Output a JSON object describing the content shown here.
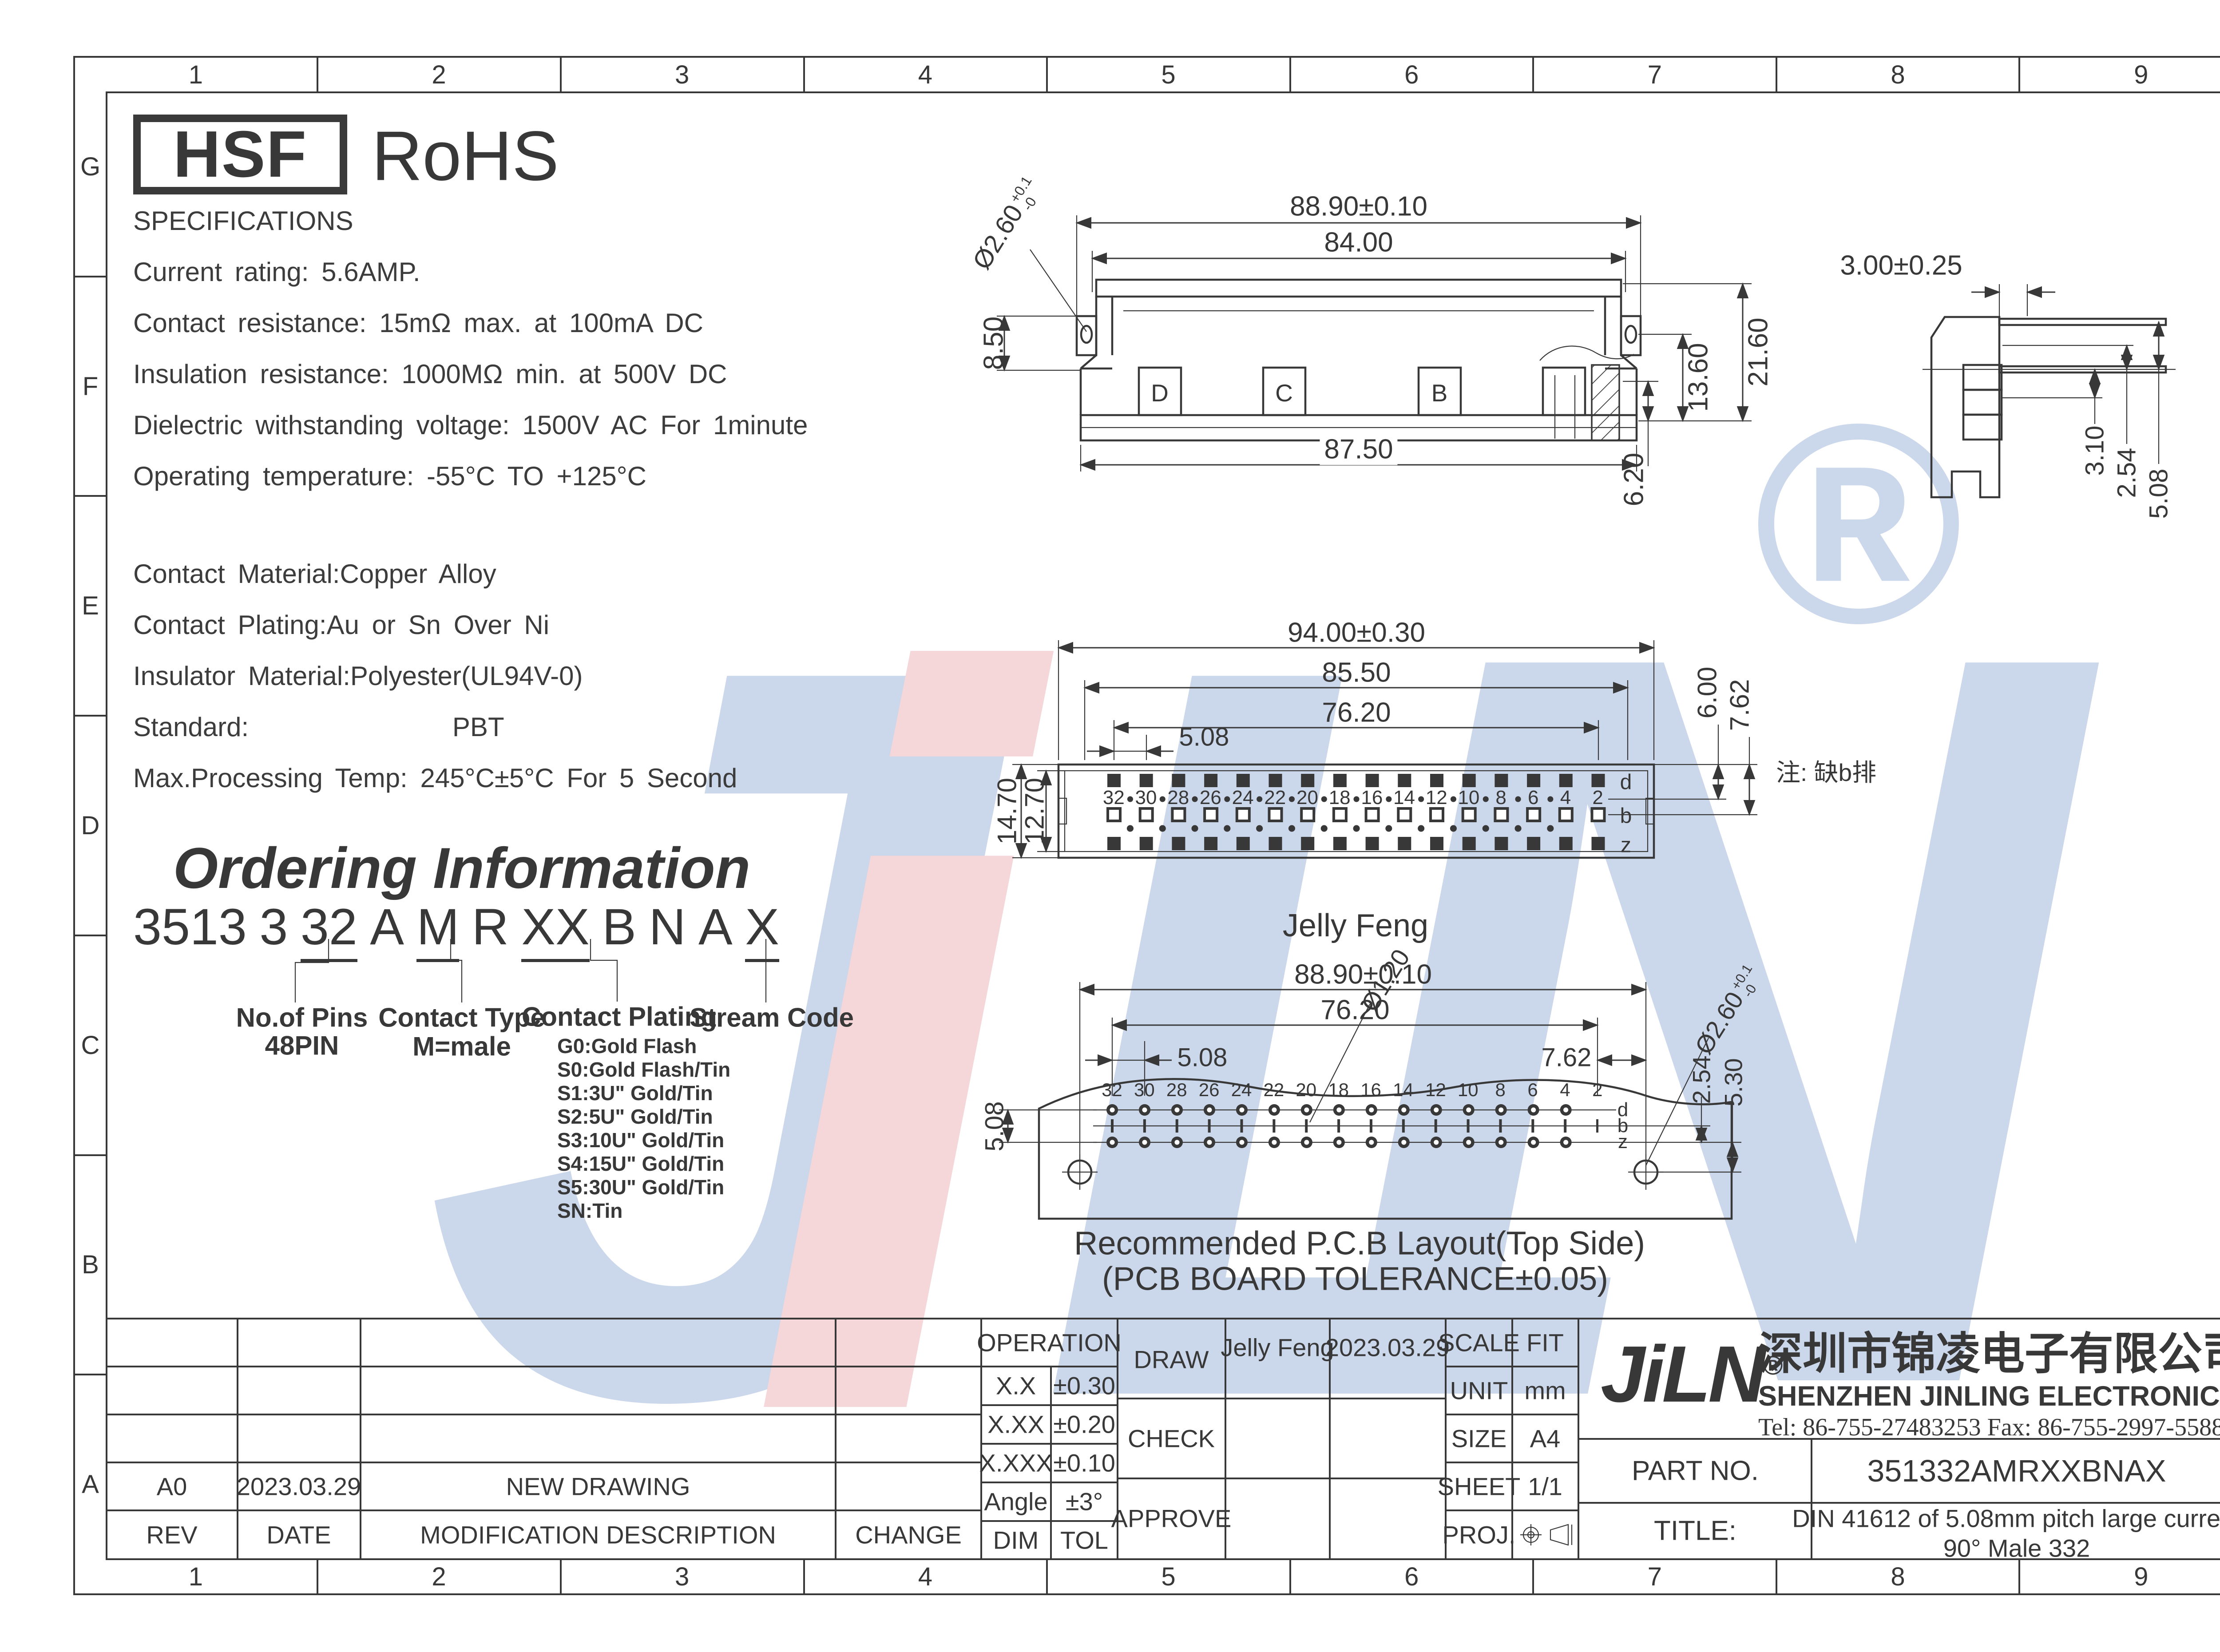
{
  "frame": {
    "columns": [
      "1",
      "2",
      "3",
      "4",
      "5",
      "6",
      "7",
      "8",
      "9"
    ],
    "rows": [
      "G",
      "F",
      "E",
      "D",
      "C",
      "B",
      "A"
    ]
  },
  "badges": {
    "hsf": "HSF",
    "rohs": "RoHS"
  },
  "specs": {
    "lines": [
      "SPECIFICATIONS",
      "Current rating: 5.6AMP.",
      "Contact resistance: 15mΩ max. at 100mA DC",
      "Insulation resistance: 1000MΩ min. at 500V DC",
      "Dielectric withstanding voltage: 1500V AC For 1minute",
      "Operating temperature: -55°C TO +125°C"
    ],
    "materials": [
      "Contact Material:Copper Alloy",
      "Contact Plating:Au or Sn Over Ni",
      "Insulator Material:Polyester(UL94V-0)",
      "Standard:                PBT",
      "Max.Processing Temp: 245°C±5°C For 5 Second"
    ]
  },
  "ordering": {
    "title": "Ordering Information",
    "tokens": [
      "3513",
      "3",
      "32",
      "A",
      "M",
      "R",
      "XX",
      "B",
      "N",
      "A",
      "X"
    ],
    "labels": {
      "pins_title": "No.of Pins",
      "pins_value": "48PIN",
      "type_title": "Contact Type",
      "type_value": "M=male",
      "plating_title": "Contact Plating",
      "stream_title": "Stream Code"
    },
    "plating_options": [
      "G0:Gold Flash",
      "S0:Gold Flash/Tin",
      "S1:3U\" Gold/Tin",
      "S2:5U\" Gold/Tin",
      "S3:10U\" Gold/Tin",
      "S4:15U\" Gold/Tin",
      "S5:30U\" Gold/Tin",
      "SN:Tin"
    ]
  },
  "watermark": {
    "l1": "J",
    "l2": "i",
    "l3": "L",
    "l4": "N",
    "registered": "®"
  },
  "view_top": {
    "dim_width_outer": "88.90±0.10",
    "dim_width_inner": "84.00",
    "dim_width_base": "87.50",
    "dim_height_total": "21.60",
    "dim_height_mid": "13.60",
    "dim_height_base": "6.20",
    "dim_left": "8.50",
    "dim_hole": "Ø2.60",
    "dim_hole_tol_up": "+0.1",
    "dim_hole_tol_dn": "-0",
    "slots": {
      "s1": "D",
      "s2": "C",
      "s3": "B"
    }
  },
  "view_face": {
    "dim_w1": "94.00±0.30",
    "dim_w2": "85.50",
    "dim_w3": "76.20",
    "dim_pitch": "5.08",
    "dim_h1": "14.70",
    "dim_h2": "12.70",
    "dim_r1": "6.00",
    "dim_r2": "7.62",
    "pins": [
      "32",
      "30",
      "28",
      "26",
      "24",
      "22",
      "20",
      "18",
      "16",
      "14",
      "12",
      "10",
      "8",
      "6",
      "4",
      "2"
    ],
    "rows": {
      "r1": "d",
      "r2": "b",
      "r3": "z"
    },
    "note": "注: 缺b排",
    "author": "Jelly Feng"
  },
  "view_pcb": {
    "dim_w1": "88.90±0.10",
    "dim_w2": "76.20",
    "dim_pitch": "5.08",
    "dim_right": "7.62",
    "dim_left": "5.08",
    "dim_r1": "2.54",
    "dim_r2": "5.30",
    "dim_hole_small": "Ø1.20",
    "dim_hole_big": "Ø2.60",
    "dim_hole_tol_up": "+0.1",
    "dim_hole_tol_dn": "-0",
    "pins": [
      "32",
      "30",
      "28",
      "26",
      "24",
      "22",
      "20",
      "18",
      "16",
      "14",
      "12",
      "10",
      "8",
      "6",
      "4",
      "2"
    ],
    "rows": {
      "r1": "d",
      "r2": "b",
      "r3": "z"
    },
    "caption_line1": "Recommended P.C.B Layout(Top Side)",
    "caption_line2": "(PCB BOARD TOLERANCE±0.05)"
  },
  "view_side": {
    "dim_top": "3.00±0.25",
    "dim_a": "3.10",
    "dim_b": "2.54",
    "dim_c": "5.08"
  },
  "titleblock": {
    "operation": "OPERATION",
    "tol_rows": [
      {
        "dim": "X.X",
        "tol": "±0.30"
      },
      {
        "dim": "X.XX",
        "tol": "±0.20"
      },
      {
        "dim": "X.XXX",
        "tol": "±0.10"
      },
      {
        "dim": "Angle",
        "tol": "±3°"
      },
      {
        "dim": "DIM",
        "tol": "TOL"
      }
    ],
    "draw_label": "DRAW",
    "check_label": "CHECK",
    "approve_label": "APPROVE",
    "draw_name": "Jelly Feng",
    "draw_date": "2023.03.29",
    "scale_label": "SCALE",
    "scale_value": "FIT",
    "unit_label": "UNIT",
    "unit_value": "mm",
    "size_label": "SIZE",
    "size_value": "A4",
    "sheet_label": "SHEET",
    "sheet_value": "1/1",
    "proj_label": "PROJ.",
    "logo": "JiLN",
    "logo_reg": "®",
    "company_cn": "深圳市锦凌电子有限公司",
    "company_en": "SHENZHEN JINLING ELECTRONICS CO.,LTD",
    "tel": "Tel: 86-755-27483253  Fax: 86-755-2997-5588",
    "partno_label": "PART NO.",
    "partno_value": "351332AMRXXBNAX",
    "title_label": "TITLE:",
    "title_line1": "DIN 41612 of 5.08mm pitch large current",
    "title_line2": "90°  Male 332",
    "rev_headers": [
      "REV",
      "DATE",
      "MODIFICATION DESCRIPTION",
      "CHANGE"
    ],
    "rev_row": {
      "rev": "A0",
      "date": "2023.03.29",
      "desc": "NEW DRAWING"
    }
  }
}
